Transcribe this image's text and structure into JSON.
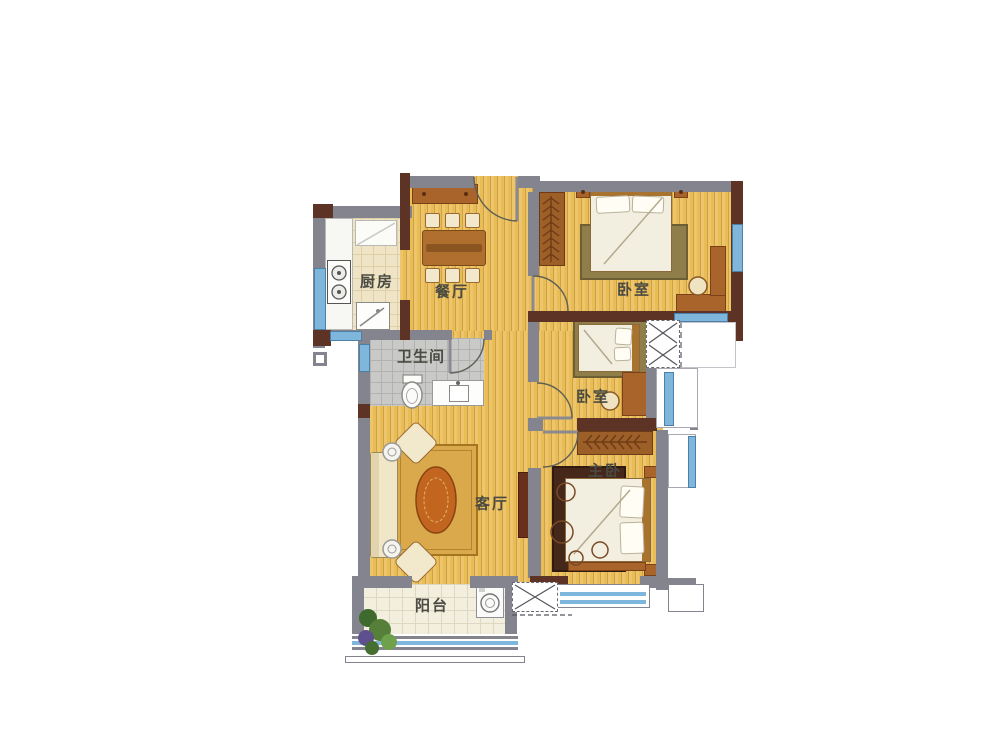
{
  "floorplan": {
    "rooms": {
      "kitchen": {
        "label": "厨房"
      },
      "dining": {
        "label": "餐厅"
      },
      "bedroom_top": {
        "label": "卧室"
      },
      "bathroom": {
        "label": "卫生间"
      },
      "bedroom_middle": {
        "label": "卧室"
      },
      "living": {
        "label": "客厅"
      },
      "master_bedroom": {
        "label": "主卧"
      },
      "balcony": {
        "label": "阳台"
      }
    },
    "colors": {
      "floor_wood": "#e9bc55",
      "wall_gray": "#84848e",
      "wall_brown": "#5c3324",
      "window_blue": "#7fb7dc",
      "kitchen_tile": "#efe4c6",
      "bathroom_tile": "#c9c9c7",
      "balcony_tile": "#f3efdf",
      "furniture_wood": "#a8642a",
      "rug_gold": "#d9a94c",
      "label_text": "#4a4a42"
    }
  }
}
